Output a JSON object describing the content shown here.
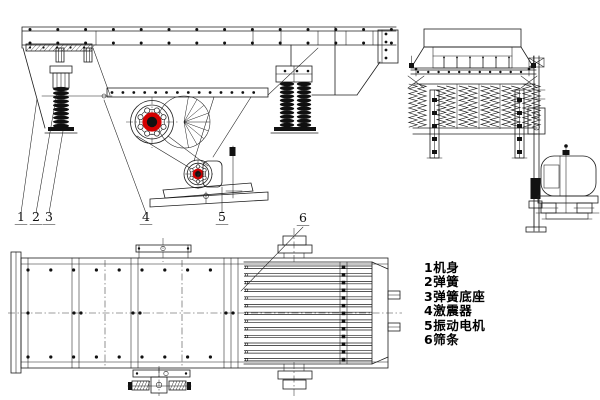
{
  "figure": {
    "background": "#ffffff",
    "line_color": "#1c1c1c",
    "accent_red": "#d40000"
  },
  "callouts": [
    {
      "num": "1",
      "label": "机身"
    },
    {
      "num": "2",
      "label": "弹簧"
    },
    {
      "num": "3",
      "label": "弹簧底座"
    },
    {
      "num": "4",
      "label": "激震器"
    },
    {
      "num": "5",
      "label": "振动电机"
    },
    {
      "num": "6",
      "label": "筛条"
    }
  ],
  "legend": {
    "items": [
      "1机身",
      "2弹簧",
      "3弹簧底座",
      "4激震器",
      "5振动电机",
      "6筛条"
    ]
  }
}
